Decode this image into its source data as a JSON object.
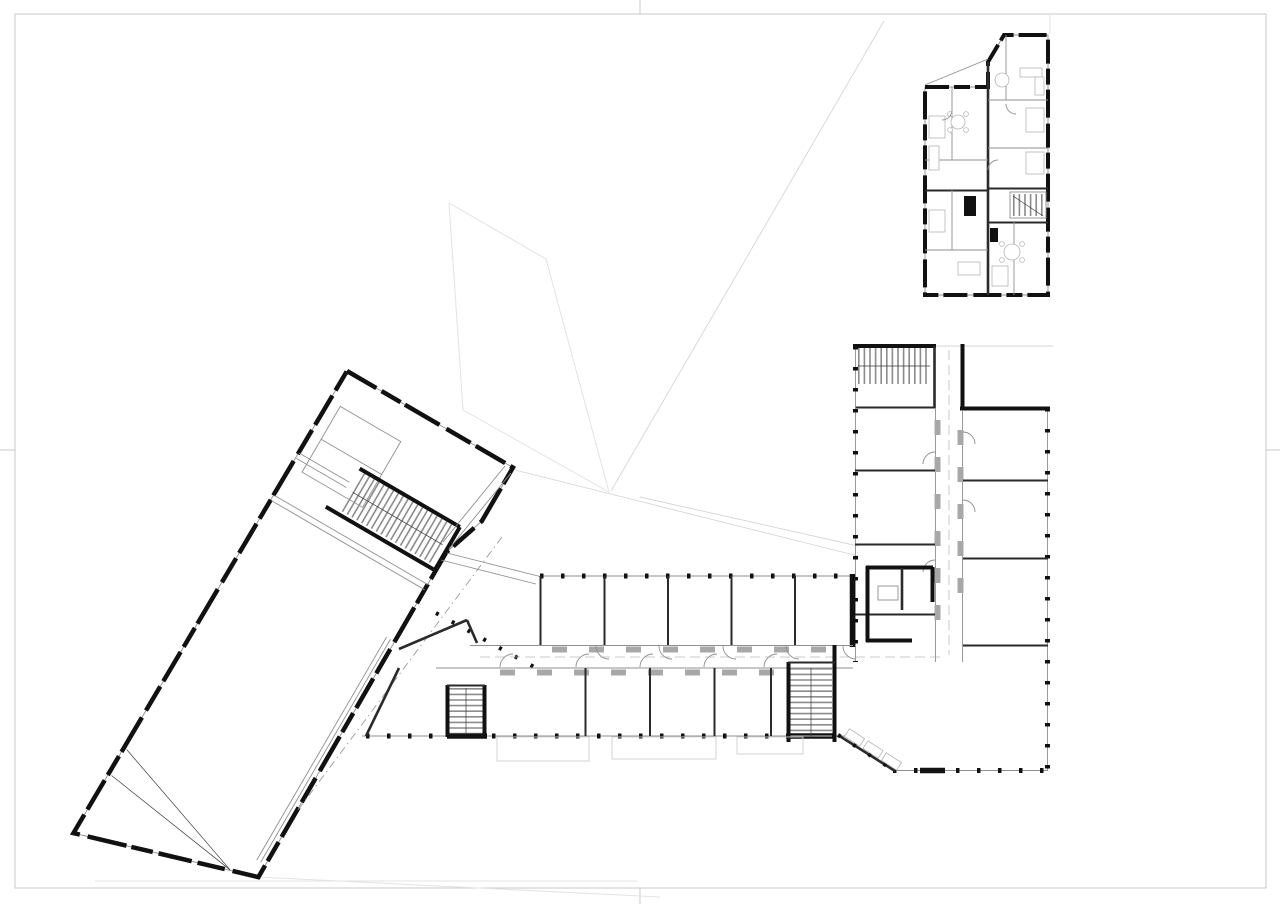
{
  "document": {
    "title": "Architectural floor plan drawing — school campus ground floor",
    "sheet": {
      "background": "#ffffff",
      "has_border": true,
      "has_fold_marks": true
    }
  },
  "colors": {
    "wall": "#111111",
    "partition": "#2a2a2a",
    "line": "#8f8f8f",
    "furniture": "#b5b5b5",
    "site_line": "#e3e3e3",
    "site_line2": "#d6d6d6",
    "sheet_border": "#c9c9c9",
    "tread": "#8c8c8c",
    "cabinet": "#a8a8a8",
    "overhang": "#9a9a9a",
    "terrace": "#cfcfcf"
  },
  "buildings": [
    {
      "id": "sports-hall",
      "description": "Large rotated hall volume with entrance foyer and main stair, lower left",
      "rotation_deg": 30
    },
    {
      "id": "classroom-wing",
      "description": "Horizontal double-loaded corridor wing with classrooms north and group rooms south, two stair cores"
    },
    {
      "id": "east-wing",
      "description": "Vertical wing with stairwell, offices west of corridor, classrooms east, service core and open learning landscape"
    },
    {
      "id": "apartment-building",
      "description": "Detached residential block top right with two units per floor and central stair"
    }
  ]
}
